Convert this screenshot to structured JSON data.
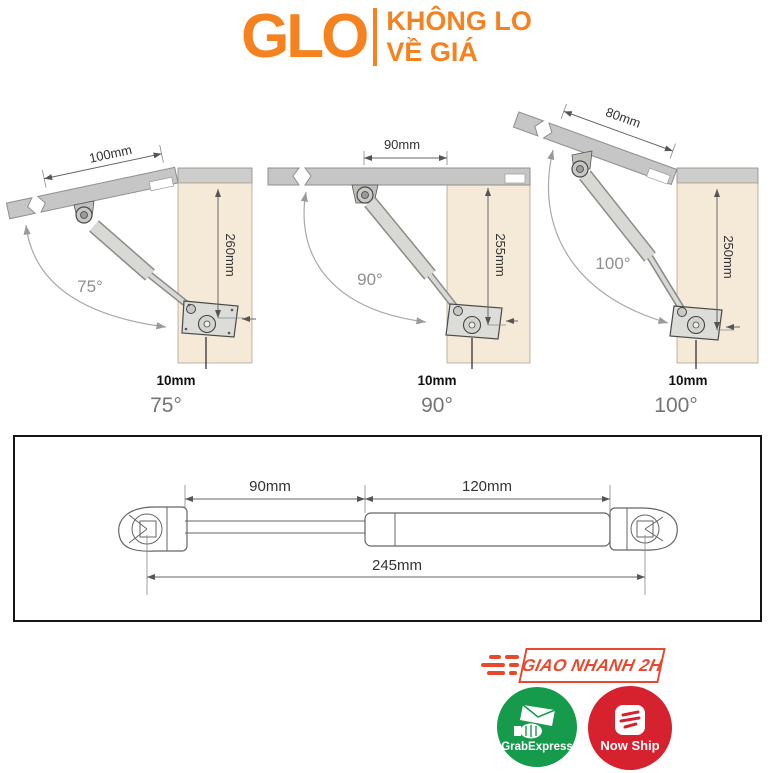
{
  "brand": {
    "logo_text": "GLO",
    "tagline_line1": "KHÔNG LO",
    "tagline_line2": "VỀ GIÁ",
    "accent_color": "#F5821F"
  },
  "angle_diagrams": [
    {
      "caption": "75°",
      "angle_label": "75°",
      "lid_dim": "100mm",
      "height_dim": "260mm",
      "offset_dim": "10mm"
    },
    {
      "caption": "90°",
      "angle_label": "90°",
      "lid_dim": "90mm",
      "height_dim": "255mm",
      "offset_dim": "10mm"
    },
    {
      "caption": "100°",
      "angle_label": "100°",
      "lid_dim": "80mm",
      "height_dim": "250mm",
      "offset_dim": "10mm"
    }
  ],
  "strut_drawing": {
    "rod_dim": "90mm",
    "body_dim": "120mm",
    "total_dim": "245mm"
  },
  "delivery": {
    "fast_badge": "GIAO NHANH 2H",
    "badge_color": "#E8492D",
    "services": [
      {
        "label": "GrabExpress",
        "color": "#169B4C",
        "icon": "hand-package-icon"
      },
      {
        "label": "Now Ship",
        "color": "#D6212F",
        "icon": "speed-lines-icon"
      }
    ]
  },
  "palette": {
    "panel_wood": "#F5E9D8",
    "lid_gray": "#C6C6C6",
    "dimension_line": "#666666"
  }
}
